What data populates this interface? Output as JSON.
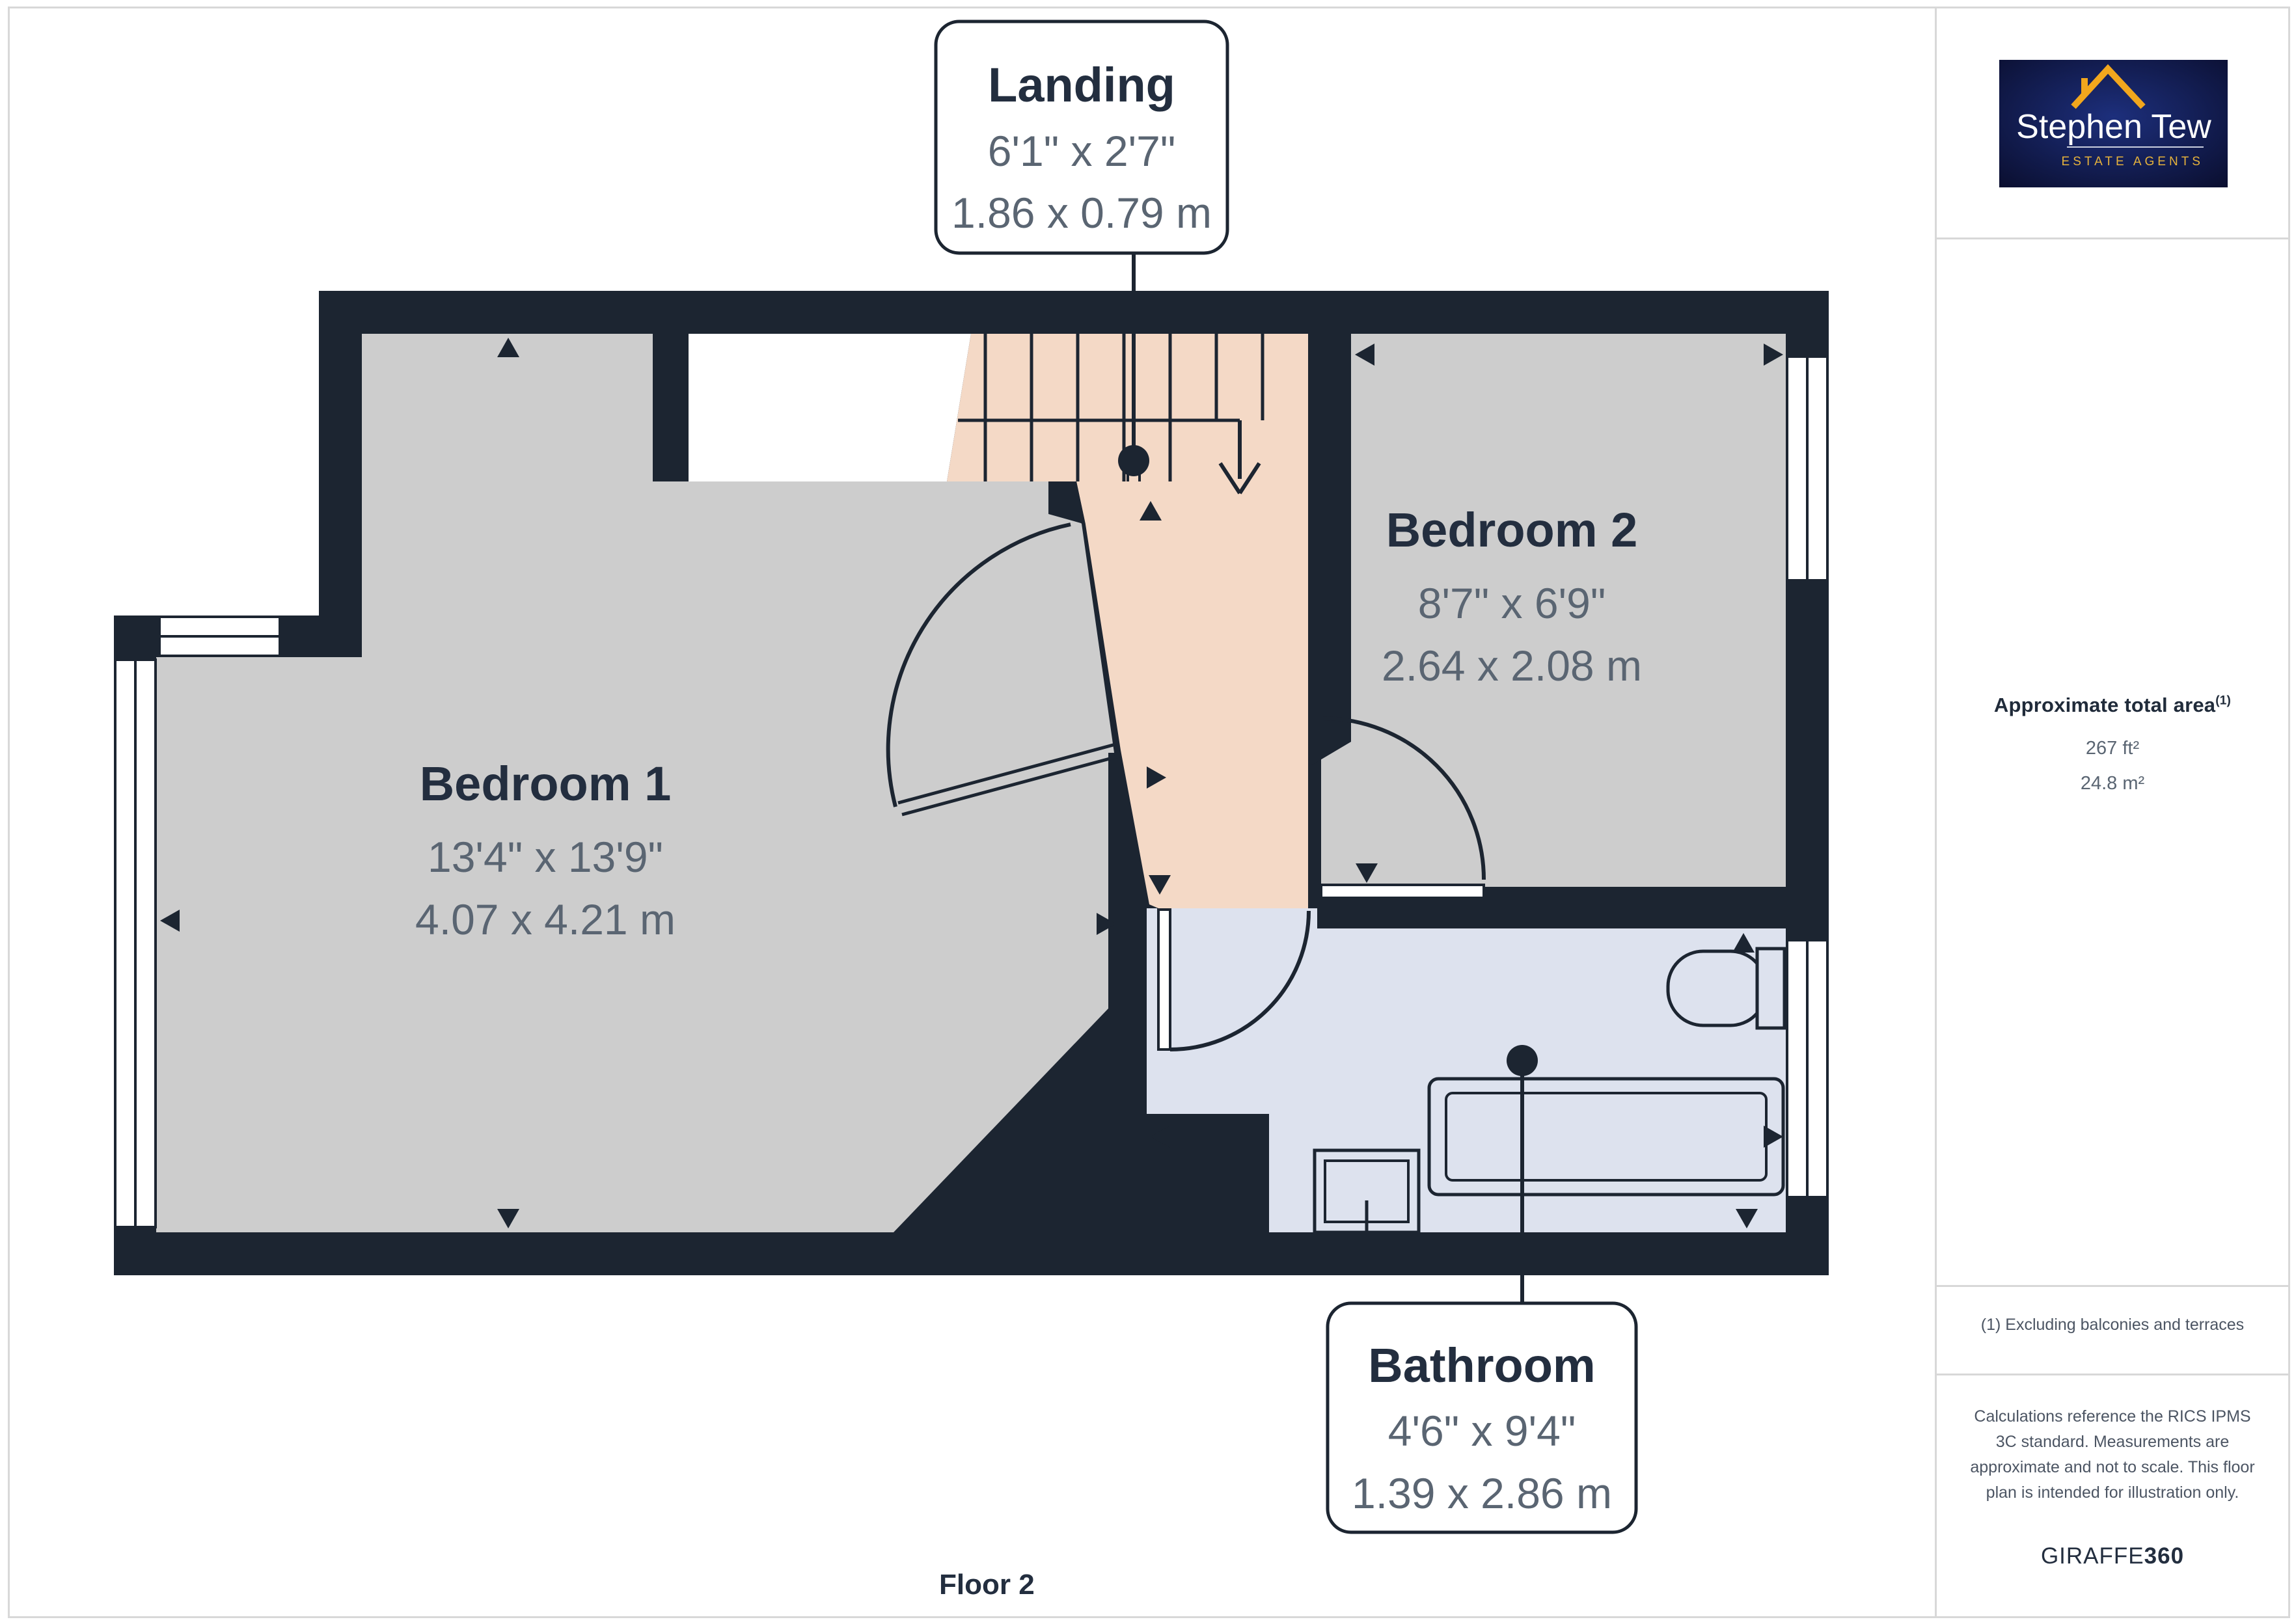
{
  "colors": {
    "wall": "#1c2531",
    "bedroom_fill": "#cdcdcd",
    "landing_fill": "#f4d9c6",
    "bathroom_fill": "#dde2ee",
    "outline_gray": "#d8d8d8",
    "title_text": "#232e3f",
    "dim_text": "#5a6572",
    "logo_navy": "#101742",
    "logo_gold": "#f2a71d"
  },
  "plan": {
    "floor_label": "Floor 2",
    "landing": {
      "name": "Landing",
      "imperial": "6'1\" x 2'7\"",
      "metric": "1.86 x 0.79 m"
    },
    "bedroom1": {
      "name": "Bedroom 1",
      "imperial": "13'4\" x 13'9\"",
      "metric": "4.07 x 4.21 m"
    },
    "bedroom2": {
      "name": "Bedroom 2",
      "imperial": "8'7\" x 6'9\"",
      "metric": "2.64 x 2.08 m"
    },
    "bathroom": {
      "name": "Bathroom",
      "imperial": "4'6\" x 9'4\"",
      "metric": "1.39 x 2.86 m"
    }
  },
  "sidebar": {
    "logo": {
      "name": "Stephen Tew",
      "tagline": "ESTATE AGENTS"
    },
    "area": {
      "title": "Approximate total area",
      "superscript": "(1)",
      "imperial": "267 ft²",
      "metric": "24.8 m²"
    },
    "footnote": "(1) Excluding balconies and terraces",
    "disclaimer": "Calculations reference the RICS IPMS 3C standard. Measurements are approximate and not to scale. This floor plan is intended for illustration only.",
    "brand": {
      "word": "GIRAFFE",
      "number": "360"
    }
  }
}
